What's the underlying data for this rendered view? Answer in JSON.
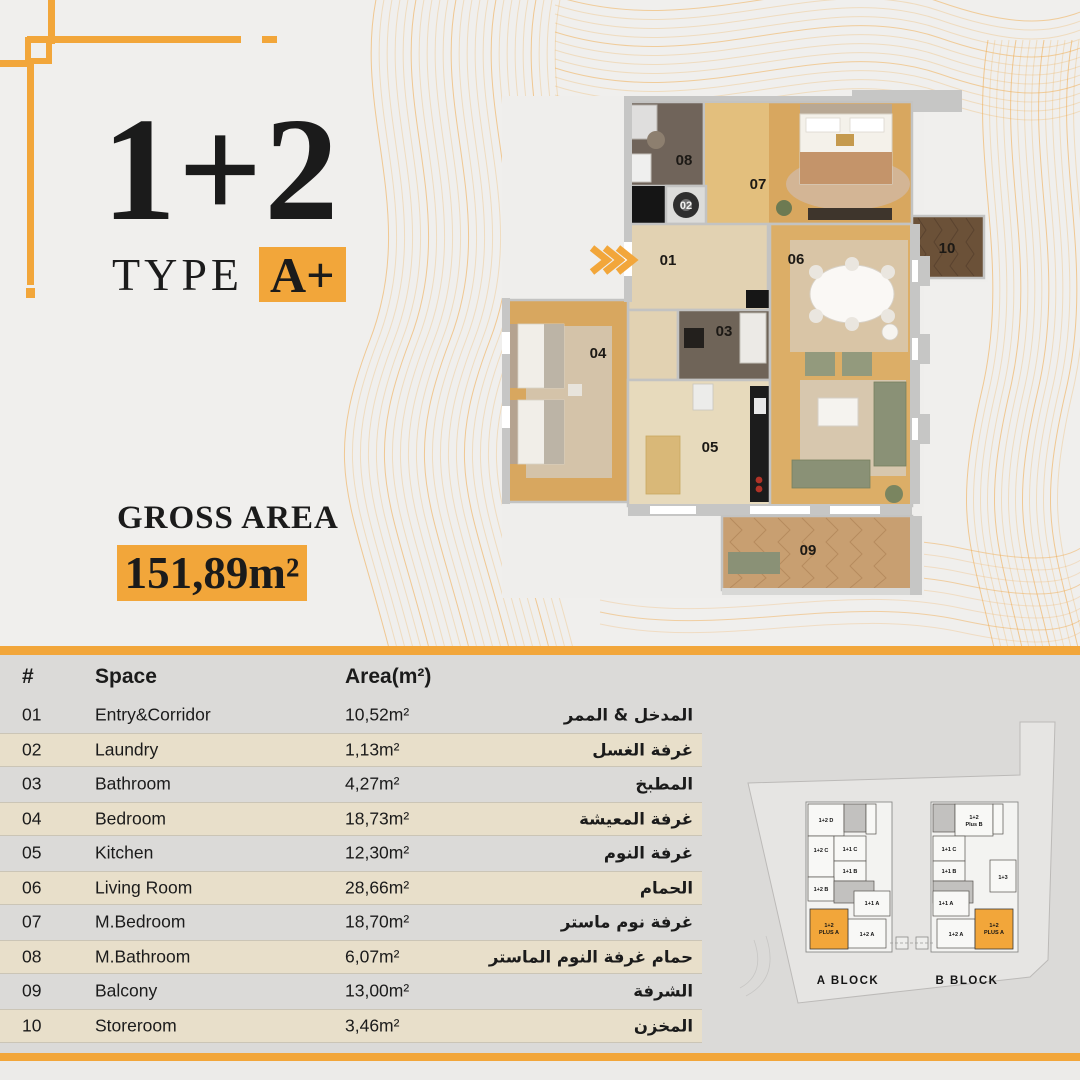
{
  "header": {
    "units": "1+2",
    "type_label": "TYPE",
    "type_value": "A+",
    "gross_area_label": "GROSS AREA",
    "gross_area_value": "151,89m²"
  },
  "colors": {
    "accent": "#F2A63A",
    "tan_row": "#E8DFCA",
    "table_bg": "#DBDAD8",
    "page_bg": "#F0EFED"
  },
  "floorplan": {
    "room_numbers": [
      "01",
      "02",
      "03",
      "04",
      "05",
      "06",
      "07",
      "08",
      "09",
      "10"
    ],
    "entry_icon": "triple-chevron-right"
  },
  "table": {
    "headers": {
      "num": "#",
      "space": "Space",
      "area": "Area(m²)"
    },
    "rows": [
      {
        "num": "01",
        "space": "Entry&Corridor",
        "area": "10,52m²",
        "ar": "المدخل & الممر"
      },
      {
        "num": "02",
        "space": "Laundry",
        "area": "1,13m²",
        "ar": "غرفة الغسل"
      },
      {
        "num": "03",
        "space": "Bathroom",
        "area": "4,27m²",
        "ar": "المطبخ"
      },
      {
        "num": "04",
        "space": "Bedroom",
        "area": "18,73m²",
        "ar": "غرفة المعيشة"
      },
      {
        "num": "05",
        "space": "Kitchen",
        "area": "12,30m²",
        "ar": "غرفة النوم"
      },
      {
        "num": "06",
        "space": "Living Room",
        "area": "28,66m²",
        "ar": "الحمام"
      },
      {
        "num": "07",
        "space": "M.Bedroom",
        "area": "18,70m²",
        "ar": "غرفة نوم ماستر"
      },
      {
        "num": "08",
        "space": "M.Bathroom",
        "area": "6,07m²",
        "ar": "حمام غرفة النوم الماستر"
      },
      {
        "num": "09",
        "space": "Balcony",
        "area": "13,00m²",
        "ar": "الشرفة"
      },
      {
        "num": "10",
        "space": "Storeroom",
        "area": "3,46m²",
        "ar": "المخزن"
      }
    ]
  },
  "siteplan": {
    "block_a": {
      "label": "A BLOCK",
      "units": {
        "u12d": "1+2 D",
        "u12c": "1+2 C",
        "u11c": "1+1 C",
        "u11b": "1+1 B",
        "u12b": "1+2 B",
        "u11a": "1+1 A",
        "u12a": "1+2 A",
        "plus_line1": "1+2",
        "plus_line2": "PLUS A"
      }
    },
    "block_b": {
      "label": "B BLOCK",
      "units": {
        "u11c": "1+1 C",
        "u11b": "1+1 B",
        "u13": "1+3",
        "u11a": "1+1 A",
        "u12a": "1+2 A",
        "plus_line1": "1+2",
        "plus_line2": "PLUS A",
        "plusb_line1": "1+2",
        "plusb_line2": "Plus B"
      }
    }
  }
}
